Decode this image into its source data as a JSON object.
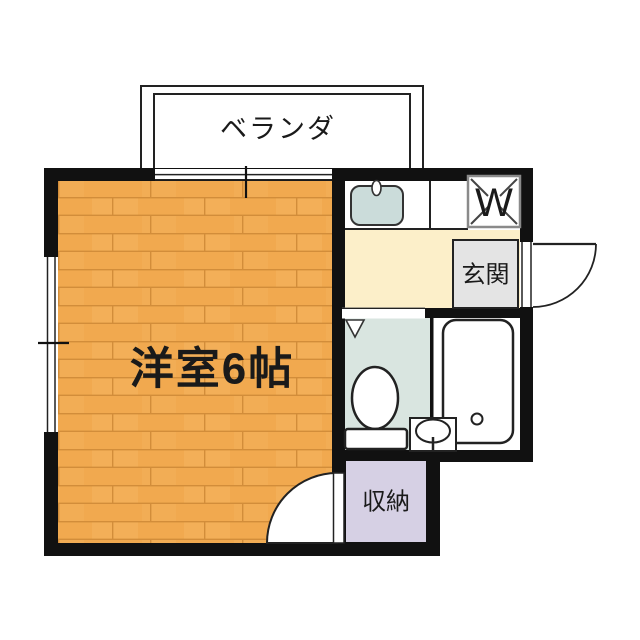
{
  "floorplan": {
    "labels": {
      "balcony": "ベランダ",
      "main_room": "洋室6帖",
      "entrance": "玄関",
      "storage": "収納",
      "washer": "W"
    },
    "colors": {
      "wall": "#111111",
      "outline": "#222222",
      "wood_floor": "#f1a94f",
      "wood_line": "#d28d3a",
      "wood_light": "#f6b765",
      "hallway": "#fcefc9",
      "toilet_room": "#d9e5e0",
      "storage": "#d6d0e4",
      "sink": "#cbdcda",
      "entrance_box": "#e4e4e4",
      "washer_box_border": "#8a8a8a"
    }
  }
}
